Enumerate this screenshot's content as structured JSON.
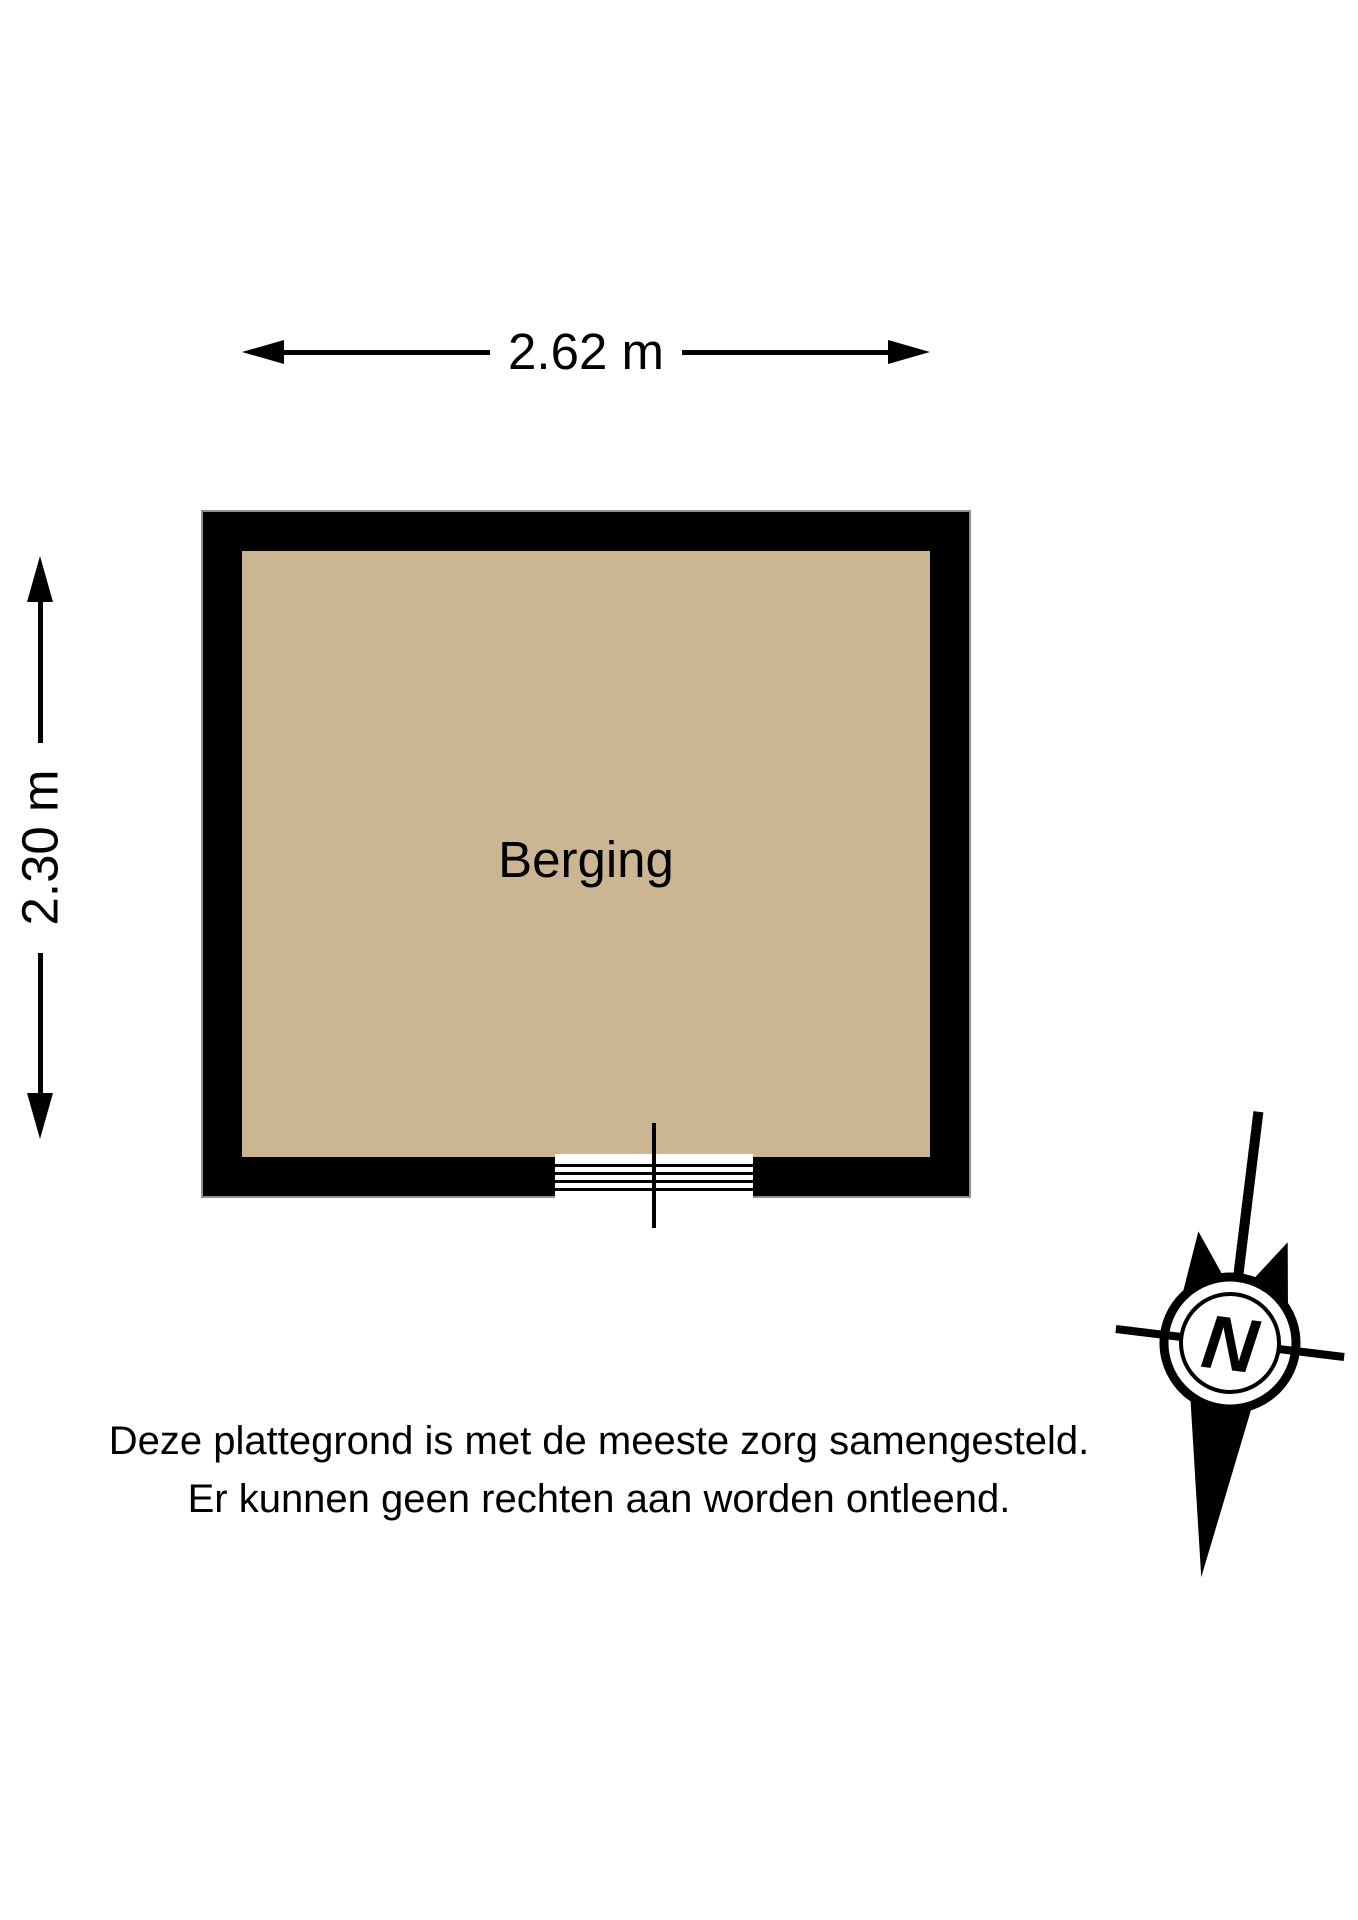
{
  "floorplan": {
    "room_label": "Berging",
    "width_dimension_label": "2.62 m",
    "height_dimension_label": "2.30 m",
    "floor_color": "#CCB593",
    "wall_color": "#000000",
    "line_color": "#000000"
  },
  "compass": {
    "label": "N"
  },
  "disclaimer": {
    "line1": "Deze plattegrond is met de meeste zorg samengesteld.",
    "line2": "Er kunnen geen rechten aan worden ontleend."
  }
}
